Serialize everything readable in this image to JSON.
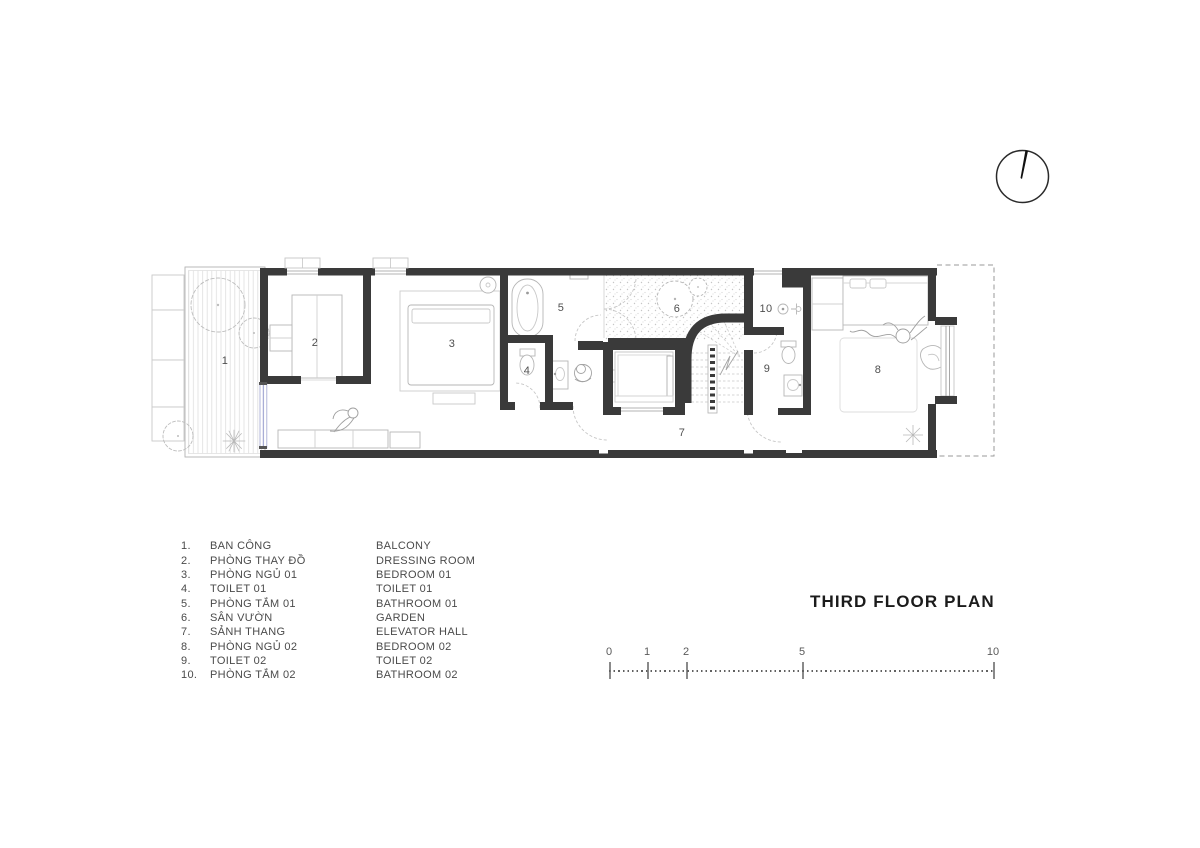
{
  "title": "THIRD FLOOR PLAN",
  "plan": {
    "room_labels": [
      "1",
      "2",
      "3",
      "4",
      "5",
      "6",
      "7",
      "8",
      "9",
      "10"
    ]
  },
  "legend": {
    "rows": [
      {
        "num": "1.",
        "vi": "BAN CÔNG",
        "en": "BALCONY"
      },
      {
        "num": "2.",
        "vi": "PHÒNG THAY ĐỒ",
        "en": "DRESSING ROOM"
      },
      {
        "num": "3.",
        "vi": "PHÒNG NGỦ 01",
        "en": "BEDROOM 01"
      },
      {
        "num": "4.",
        "vi": "TOILET 01",
        "en": "TOILET 01"
      },
      {
        "num": "5.",
        "vi": "PHÒNG TẮM 01",
        "en": "BATHROOM 01"
      },
      {
        "num": "6.",
        "vi": "SÂN VƯỜN",
        "en": "GARDEN"
      },
      {
        "num": "7.",
        "vi": "SẢNH THANG",
        "en": "ELEVATOR HALL"
      },
      {
        "num": "8.",
        "vi": "PHÒNG NGỦ 02",
        "en": "BEDROOM 02"
      },
      {
        "num": "9.",
        "vi": "TOILET 02",
        "en": "TOILET 02"
      },
      {
        "num": "10.",
        "vi": "PHÒNG TẮM 02",
        "en": "BATHROOM 02"
      }
    ]
  },
  "scale_bar": {
    "labels": [
      "0",
      "1",
      "2",
      "5",
      "10"
    ]
  },
  "colors": {
    "wall": "#3a3a3a",
    "furniture_line": "#b6b6b6",
    "light_line": "#d8d8d8",
    "text": "#4a4a4a",
    "sliding_door": "#a9aed6",
    "title_text": "#1b1b1b"
  }
}
